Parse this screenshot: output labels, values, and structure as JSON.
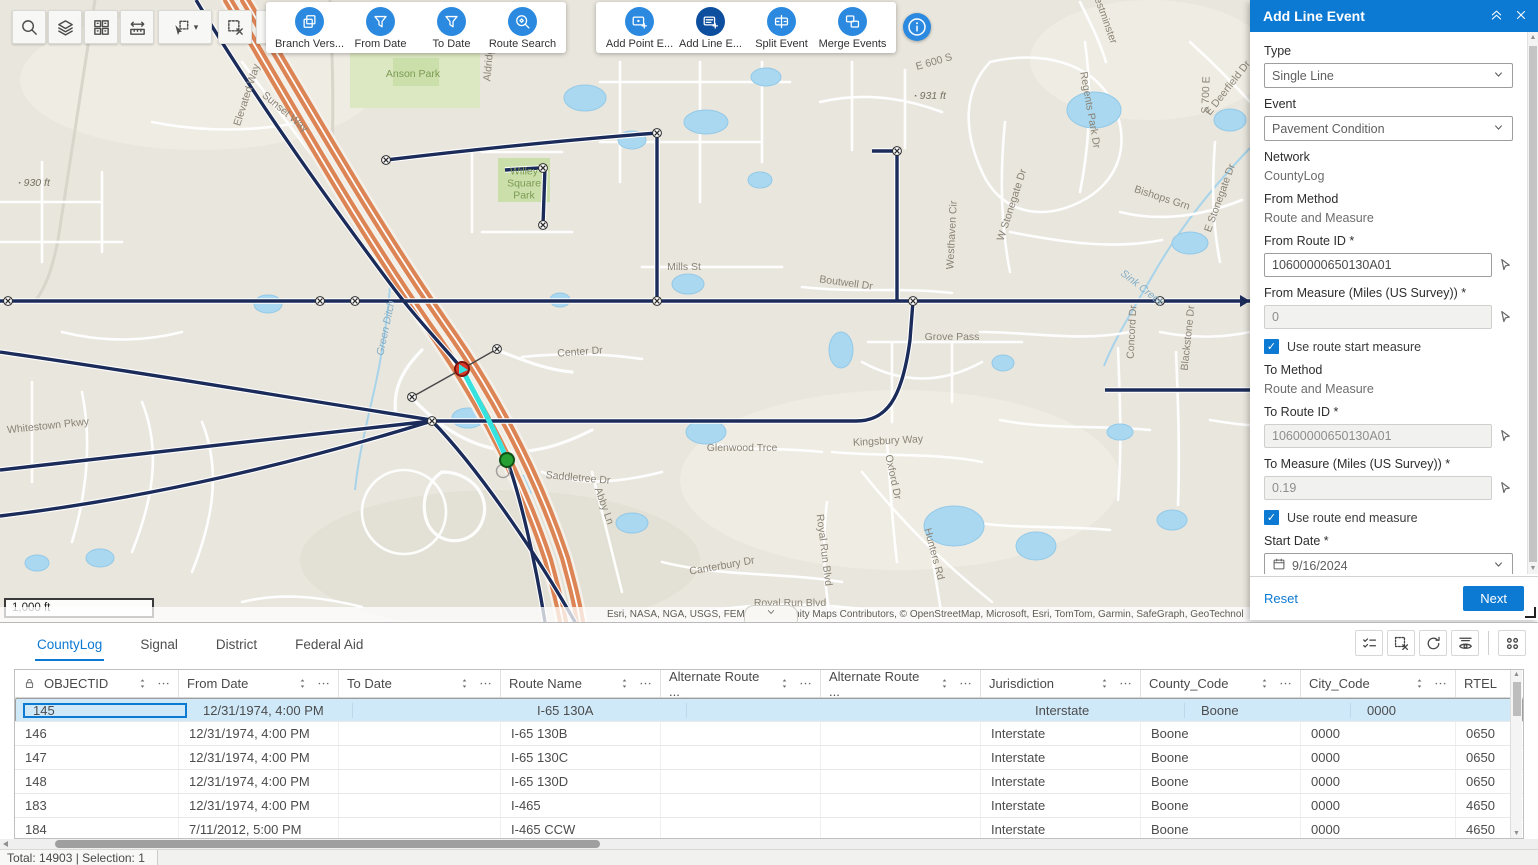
{
  "accent_color": "#0c79d2",
  "toolbar": {
    "map_tools": [
      {
        "icon": "search-icon"
      },
      {
        "icon": "layers-icon"
      },
      {
        "icon": "grid-icon"
      },
      {
        "icon": "measure-icon"
      },
      {
        "icon": "select-icon",
        "caret": true
      },
      {
        "icon": "clear-selection-icon"
      },
      {
        "icon": "route-select-icon"
      }
    ],
    "event_groups": [
      {
        "buttons": [
          {
            "label": "Branch Vers...",
            "icon": "branch-versions-icon"
          },
          {
            "label": "From Date",
            "icon": "from-date-filter-icon"
          },
          {
            "label": "To Date",
            "icon": "to-date-filter-icon"
          },
          {
            "label": "Route Search",
            "icon": "route-search-icon"
          }
        ]
      },
      {
        "buttons": [
          {
            "label": "Add Point E...",
            "icon": "add-point-event-icon"
          },
          {
            "label": "Add Line E...",
            "icon": "add-line-event-icon",
            "active": true
          },
          {
            "label": "Split Event",
            "icon": "split-event-icon"
          },
          {
            "label": "Merge Events",
            "icon": "merge-events-icon"
          }
        ]
      }
    ],
    "info_button_icon": "info-icon"
  },
  "map": {
    "scale_label": "1,000 ft",
    "attribution": "Esri, NASA, NGA, USGS, FEMA | Community Maps Contributors, © OpenStreetMap, Microsoft, Esri, TomTom, Garmin, SafeGraph, GeoTechnol",
    "labels": [
      {
        "t": "Elevated Way",
        "x": 247,
        "y": 95,
        "r": -72
      },
      {
        "t": "Sunset Way",
        "x": 285,
        "y": 112,
        "r": 40
      },
      {
        "t": "Anson Park",
        "x": 413,
        "y": 74,
        "cls": "park"
      },
      {
        "t": "Willey Square Park",
        "x": 524,
        "y": 184,
        "cls": "park wrap"
      },
      {
        "t": "Aldridge",
        "x": 489,
        "y": 62,
        "r": -85
      },
      {
        "t": "Mills St",
        "x": 684,
        "y": 267
      },
      {
        "t": "Center Dr",
        "x": 580,
        "y": 352,
        "r": -4
      },
      {
        "t": "Grove Pass",
        "x": 952,
        "y": 337
      },
      {
        "t": "Boutwell Dr",
        "x": 846,
        "y": 283,
        "r": 8
      },
      {
        "t": "Kingsbury Way",
        "x": 888,
        "y": 441,
        "r": -3
      },
      {
        "t": "Glenwood Trce",
        "x": 742,
        "y": 448
      },
      {
        "t": "Saddletree Dr",
        "x": 578,
        "y": 478,
        "r": 5
      },
      {
        "t": "Canterbury Dr",
        "x": 722,
        "y": 566,
        "r": -10
      },
      {
        "t": "Royal Run Blvd",
        "x": 790,
        "y": 603
      },
      {
        "t": "Royal Run Blvd",
        "x": 824,
        "y": 550,
        "r": 83
      },
      {
        "t": "Abby Ln",
        "x": 604,
        "y": 506,
        "r": 70
      },
      {
        "t": "Oxford Dr",
        "x": 893,
        "y": 477,
        "r": 78
      },
      {
        "t": "Hunters Rd",
        "x": 934,
        "y": 554,
        "r": 75
      },
      {
        "t": "E 600 S",
        "x": 934,
        "y": 62,
        "r": -16
      },
      {
        "t": "931 ft",
        "x": 930,
        "y": 96,
        "cls": "elev"
      },
      {
        "t": "930 ft",
        "x": 34,
        "y": 183,
        "cls": "elev"
      },
      {
        "t": "Westhaven Cir",
        "x": 952,
        "y": 235,
        "r": -87
      },
      {
        "t": "W Stonegate Dr",
        "x": 1012,
        "y": 205,
        "r": -72
      },
      {
        "t": "Regents Park Dr",
        "x": 1090,
        "y": 110,
        "r": 80
      },
      {
        "t": "Bishops Grn",
        "x": 1162,
        "y": 198,
        "r": 18
      },
      {
        "t": "E Stonegate Dr",
        "x": 1220,
        "y": 198,
        "r": -70
      },
      {
        "t": "E Deerfield Dr",
        "x": 1228,
        "y": 88,
        "r": -52
      },
      {
        "t": "Westminster",
        "x": 1104,
        "y": 16,
        "r": 70
      },
      {
        "t": "S 700 E",
        "x": 1206,
        "y": 95,
        "r": -88
      },
      {
        "t": "Sink Creek",
        "x": 1142,
        "y": 288,
        "r": 38,
        "cls": "water"
      },
      {
        "t": "Concord Dr",
        "x": 1132,
        "y": 332,
        "r": -87
      },
      {
        "t": "Blackstone Dr",
        "x": 1188,
        "y": 338,
        "r": -84
      },
      {
        "t": "Green Ditch",
        "x": 386,
        "y": 328,
        "r": -78,
        "cls": "water"
      },
      {
        "t": "Whitestown Pkwy",
        "x": 48,
        "y": 426,
        "r": -6
      }
    ]
  },
  "panel": {
    "title": "Add Line Event",
    "type": {
      "label": "Type",
      "value": "Single Line"
    },
    "event": {
      "label": "Event",
      "value": "Pavement Condition"
    },
    "network": {
      "label": "Network",
      "value": "CountyLog"
    },
    "from_method": {
      "label": "From Method",
      "value": "Route and Measure"
    },
    "from_route": {
      "label": "From Route ID *",
      "value": "10600000650130A01"
    },
    "from_measure": {
      "label": "From Measure (Miles (US Survey)) *",
      "value": "0"
    },
    "use_route_start_measure": {
      "label": "Use route start measure",
      "checked": true
    },
    "to_method": {
      "label": "To Method",
      "value": "Route and Measure"
    },
    "to_route": {
      "label": "To Route ID *",
      "value": "10600000650130A01"
    },
    "to_measure": {
      "label": "To Measure (Miles (US Survey)) *",
      "value": "0.19"
    },
    "use_route_end_measure": {
      "label": "Use route end measure",
      "checked": true
    },
    "start_date": {
      "label": "Start Date *",
      "value": "9/16/2024"
    },
    "use_route_start_date": {
      "label": "Use route start date",
      "checked": false
    },
    "end_date": {
      "label": "End Date",
      "placeholder": "MM/DD/YYYY"
    },
    "use_route_end_date": {
      "label": "Use route end date",
      "checked": false
    },
    "reset_label": "Reset",
    "next_label": "Next"
  },
  "table": {
    "tabs": [
      {
        "label": "CountyLog",
        "active": true
      },
      {
        "label": "Signal"
      },
      {
        "label": "District"
      },
      {
        "label": "Federal Aid"
      }
    ],
    "toolbar_icons": [
      "show-selection-icon",
      "clear-table-selection-icon",
      "refresh-icon",
      "fields-visibility-icon",
      "options-grid-icon"
    ],
    "columns": [
      {
        "label": "OBJECTID",
        "locked": true
      },
      {
        "label": "From Date"
      },
      {
        "label": "To Date"
      },
      {
        "label": "Route Name"
      },
      {
        "label": "Alternate Route ..."
      },
      {
        "label": "Alternate Route ..."
      },
      {
        "label": "Jurisdiction"
      },
      {
        "label": "County_Code"
      },
      {
        "label": "City_Code"
      },
      {
        "label": "RTEL"
      }
    ],
    "rows": [
      {
        "selected": true,
        "cells": [
          "145",
          "12/31/1974, 4:00 PM",
          "",
          "I-65 130A",
          "",
          "",
          "Interstate",
          "Boone",
          "0000",
          "0650"
        ]
      },
      {
        "cells": [
          "146",
          "12/31/1974, 4:00 PM",
          "",
          "I-65 130B",
          "",
          "",
          "Interstate",
          "Boone",
          "0000",
          "0650"
        ]
      },
      {
        "cells": [
          "147",
          "12/31/1974, 4:00 PM",
          "",
          "I-65 130C",
          "",
          "",
          "Interstate",
          "Boone",
          "0000",
          "0650"
        ]
      },
      {
        "cells": [
          "148",
          "12/31/1974, 4:00 PM",
          "",
          "I-65 130D",
          "",
          "",
          "Interstate",
          "Boone",
          "0000",
          "0650"
        ]
      },
      {
        "cells": [
          "183",
          "12/31/1974, 4:00 PM",
          "",
          "I-465",
          "",
          "",
          "Interstate",
          "Boone",
          "0000",
          "4650"
        ]
      },
      {
        "cells": [
          "184",
          "7/11/2012, 5:00 PM",
          "",
          "I-465 CCW",
          "",
          "",
          "Interstate",
          "Boone",
          "0000",
          "4650"
        ]
      }
    ],
    "status": "Total: 14903 | Selection: 1"
  }
}
